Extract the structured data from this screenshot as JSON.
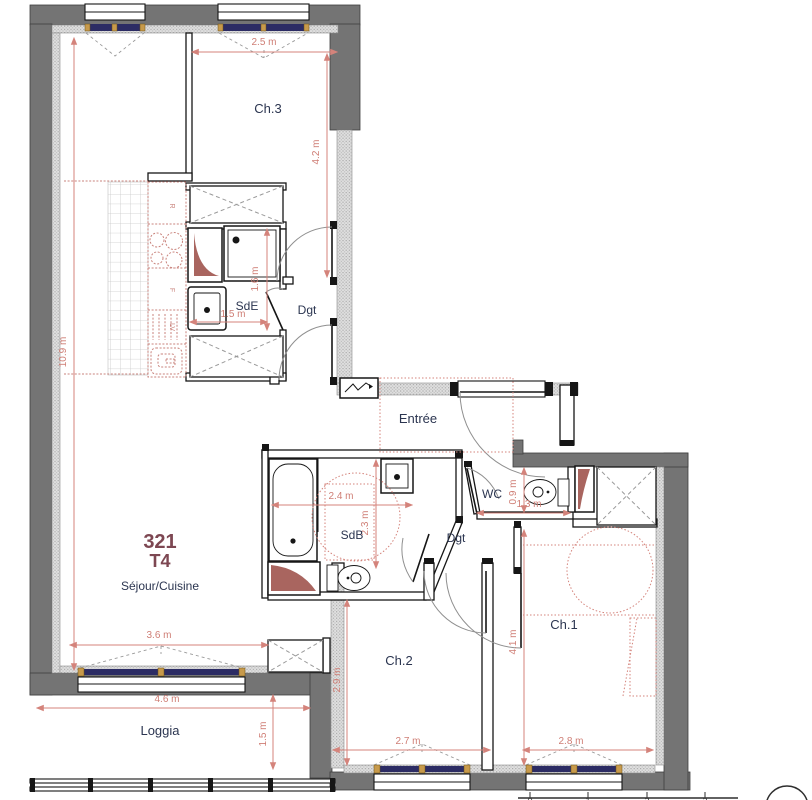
{
  "unit": {
    "number": "321",
    "type": "T4"
  },
  "rooms": {
    "ch3": "Ch.3",
    "sde": "SdE",
    "dgt_upper": "Dgt",
    "entree": "Entrée",
    "wc": "WC",
    "sdb": "SdB",
    "dgt_lower": "Dgt",
    "sejour": "Séjour/Cuisine",
    "ch2": "Ch.2",
    "ch1": "Ch.1",
    "loggia": "Loggia"
  },
  "dimensions": {
    "ch3_width": "2.5 m",
    "ch3_height": "4.2 m",
    "left_height": "10.9 m",
    "sde_height": "1.6 m",
    "sde_width": "1.5 m",
    "sdb_width": "2.4 m",
    "sdb_height": "2.3 m",
    "wc_height": "0.9 m",
    "wc_width": "1.3 m",
    "sejour_width": "3.6 m",
    "loggia_width": "4.6 m",
    "loggia_height": "1.5 m",
    "ch2_height": "2.9 m",
    "ch2_width": "2.7 m",
    "ch1_height": "4.1 m",
    "ch1_width": "2.8 m"
  },
  "kitchen": {
    "fridge": "R",
    "oven": "F",
    "dishwasher": "LV"
  },
  "scale_bar": {
    "t0": "0",
    "t1": "1",
    "t2": "2",
    "t3": "3"
  },
  "colors": {
    "wall": "#747474",
    "insulation": "#dedede",
    "dimension": "#d4837b",
    "furniture_red": "#c9837c",
    "shaft": "#a9655f",
    "room_label": "#2b3550",
    "unit_label": "#7d4752",
    "window_glass": "#2c2c64",
    "window_frame": "#c79a4b"
  }
}
